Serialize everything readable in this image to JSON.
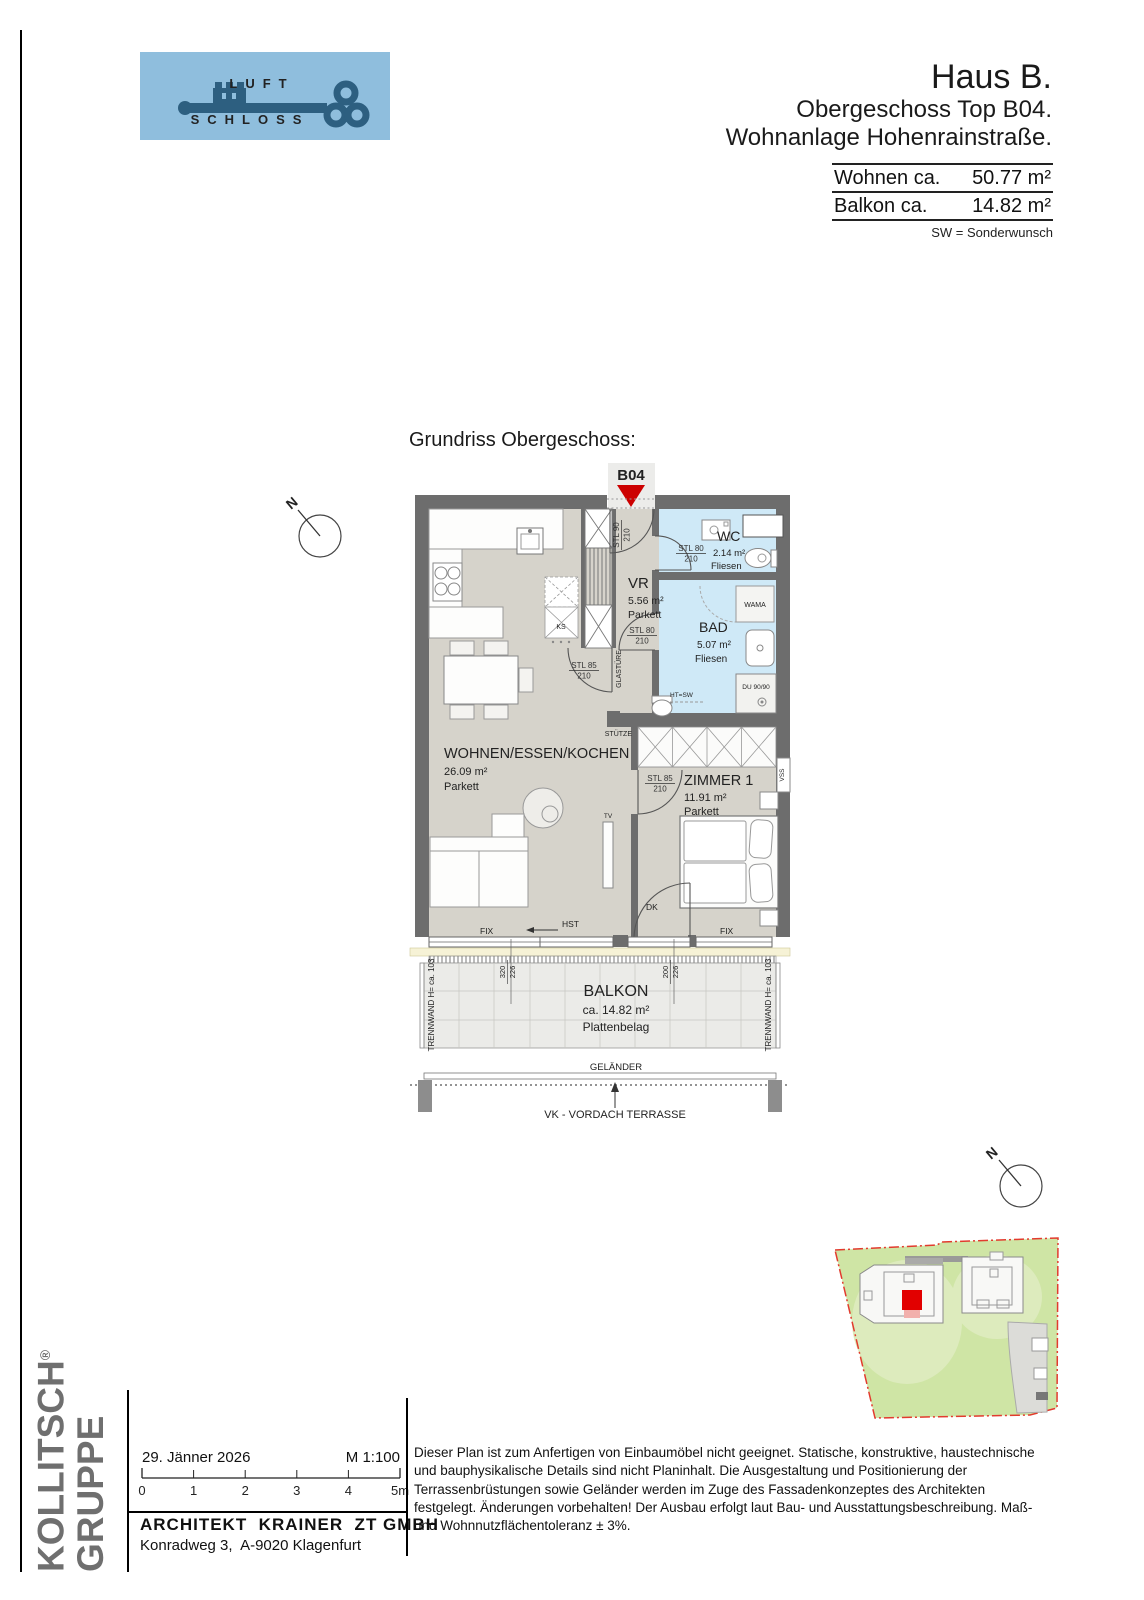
{
  "header": {
    "logo": {
      "line1": "LUFT",
      "line2": "SCHLOSS"
    },
    "title": "Haus B.",
    "subtitle_line1": "Obergeschoss Top B04.",
    "subtitle_line2": "Wohnanlage Hohenrainstraße.",
    "area_table": {
      "rows": [
        {
          "label": "Wohnen ca.",
          "value": "50.77 m²"
        },
        {
          "label": "Balkon ca.",
          "value": "14.82 m²"
        }
      ],
      "note": "SW = Sonderwunsch"
    }
  },
  "plan": {
    "heading": "Grundriss Obergeschoss:",
    "unit_marker": "B04",
    "north_label": "N",
    "rooms": {
      "wohnen": {
        "name": "WOHNEN/ESSEN/KOCHEN",
        "area": "26.09 m²",
        "floor": "Parkett"
      },
      "vr": {
        "name": "VR",
        "area": "5.56 m²",
        "floor": "Parkett"
      },
      "wc": {
        "name": "WC",
        "area": "2.14 m²",
        "floor": "Fliesen"
      },
      "bad": {
        "name": "BAD",
        "area": "5.07 m²",
        "floor": "Fliesen"
      },
      "zimmer1": {
        "name": "ZIMMER 1",
        "area": "11.91 m²",
        "floor": "Parkett"
      },
      "balkon": {
        "name": "BALKON",
        "area": "ca. 14.82 m²",
        "floor": "Plattenbelag"
      }
    },
    "door_labels": {
      "entrance_type": "STL 90",
      "std80": "STL 80",
      "std85": "STL 85",
      "height": "210",
      "glass_door": "GLASTÜRE"
    },
    "annotations": {
      "stuetze": "STÜTZE",
      "ks": "KS",
      "wama": "WAMA",
      "du": "DU 90/90",
      "htsw": "HT=SW",
      "tv": "TV",
      "vss": "VSS",
      "fix": "FIX",
      "hst": "HST",
      "dk": "DK",
      "gelaender": "GELÄNDER",
      "vordach": "VK - VORDACH TERRASSE",
      "trennwand": "TRENNWAND H= ca. 103",
      "win_left_width": "320",
      "win_left_height": "226",
      "win_right_width": "200",
      "win_right_height": "226"
    }
  },
  "footer": {
    "brand_line1": "KOLLITSCH",
    "brand_reg": "®",
    "brand_line2": "GRUPPE",
    "date": "29. Jänner 2026",
    "scale": "M 1:100",
    "scale_ticks": [
      "0",
      "1",
      "2",
      "3",
      "4",
      "5m"
    ],
    "architect": "ARCHITEKT  KRAINER  ZT GMBH",
    "address": "Konradweg 3,  A-9020 Klagenfurt",
    "disclaimer": "Dieser Plan ist zum Anfertigen von Einbaumöbel nicht geeignet. Statische, konstruktive, haustechnische und bauphysikalische Details sind nicht Planinhalt. Die Ausgestaltung und Positionierung der Terrassenbrüstungen sowie Geländer werden im Zuge des Fassadenkonzeptes des Architekten festgelegt. Änderungen vorbehalten! Der Ausbau erfolgt laut Bau- und Ausstattungsbeschreibung. Maß- und Wohnnutzflächentoleranz ± 3%."
  },
  "colors": {
    "wall": "#6d6d6d",
    "floor_parkett": "#d6d3cb",
    "floor_fliesen": "#cfe9f7",
    "balcony": "#ebebe8",
    "window_sill": "#f6f2d6",
    "accent_red": "#cc0000",
    "logo_background": "#8fbedd",
    "logo_key": "#2d5f80",
    "brand_gray": "#6f6f6f",
    "site_green": "#cfe5a5",
    "site_boundary_red": "#e23b2e"
  }
}
